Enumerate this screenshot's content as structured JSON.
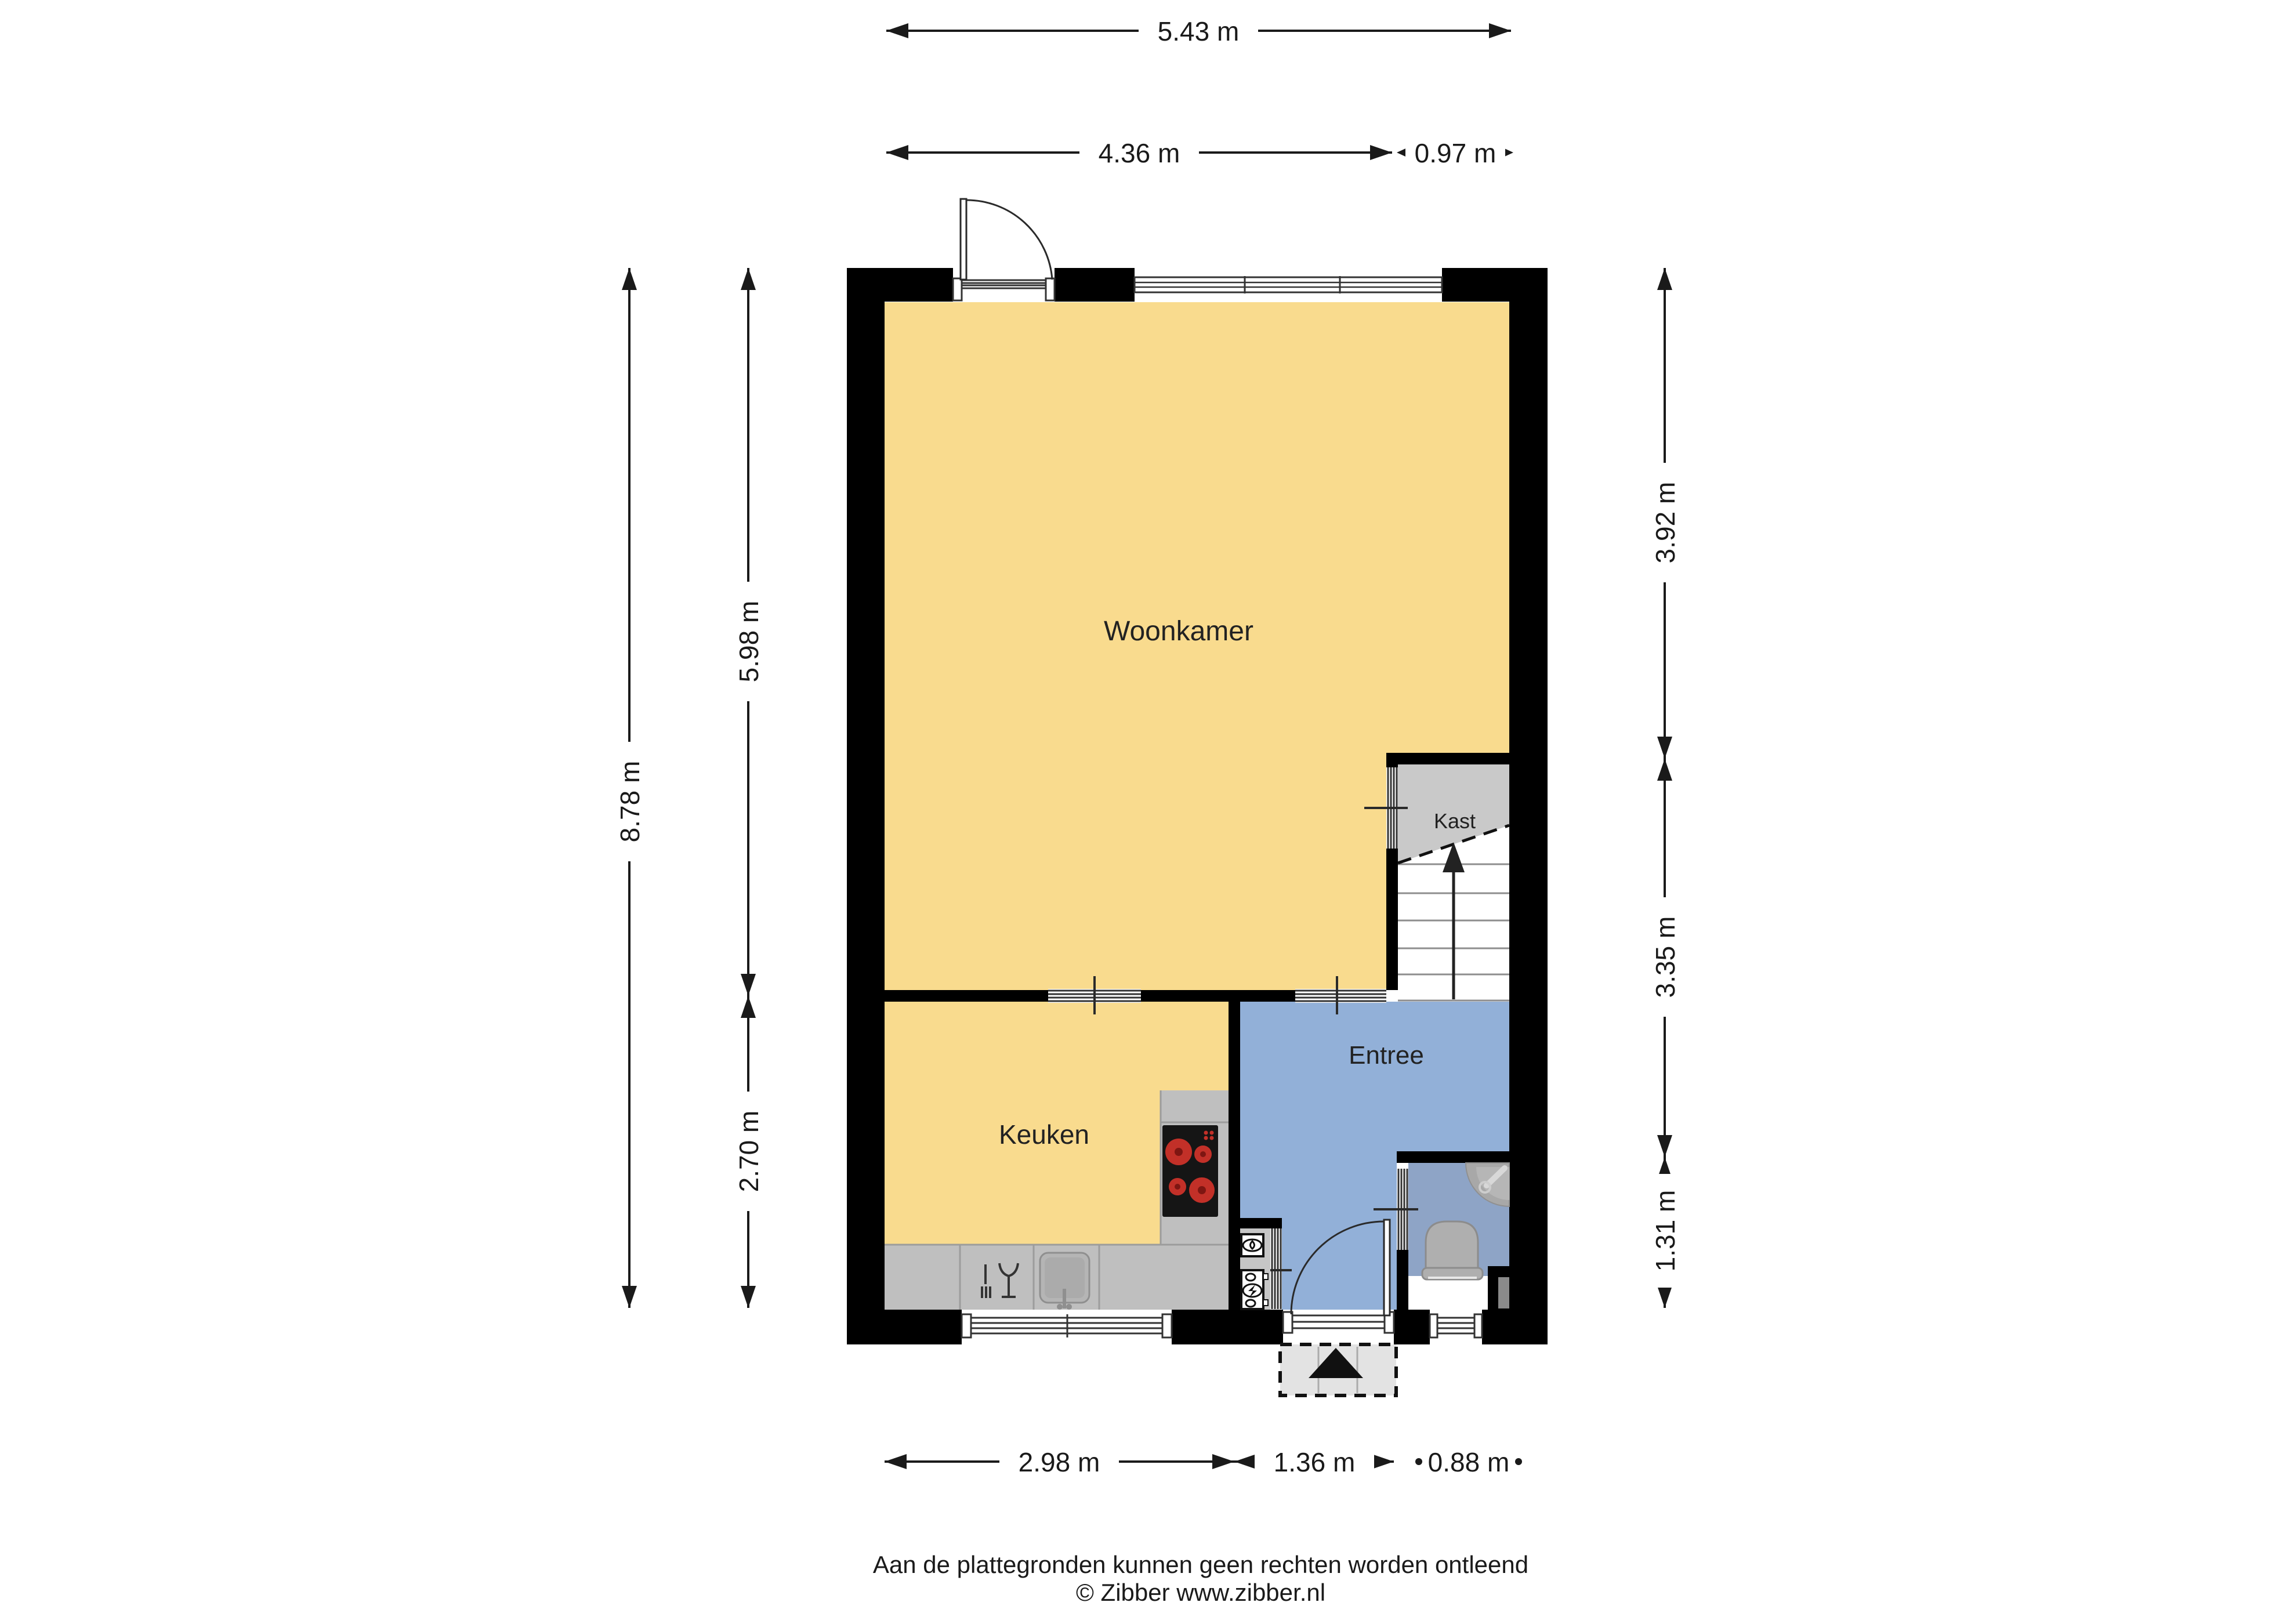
{
  "rooms": {
    "woonkamer": "Woonkamer",
    "keuken": "Keuken",
    "entree": "Entree",
    "kast": "Kast"
  },
  "dimensions": {
    "top": {
      "total": "5.43 m",
      "left": "4.36 m",
      "right": "0.97 m"
    },
    "left": {
      "total": "8.78 m",
      "upper": "5.98 m",
      "lower": "2.70 m"
    },
    "right": {
      "upper": "3.92 m",
      "middle": "3.35 m",
      "lower": "1.31 m"
    },
    "bottom": {
      "left": "2.98 m",
      "middle": "1.36 m",
      "right": "0.88 m"
    }
  },
  "footer": {
    "disclaimer": "Aan de plattegronden kunnen geen rechten worden ontleend",
    "copyright": "© Zibber www.zibber.nl"
  },
  "colors": {
    "wall": "#000000",
    "floor_living": "#F9DB8E",
    "floor_hall": "#92B0D8",
    "floor_toilet": "#8EA4C6",
    "closet": "#C9C9C9",
    "counter": "#BFBFBF",
    "mat": "#E3E3E3"
  }
}
